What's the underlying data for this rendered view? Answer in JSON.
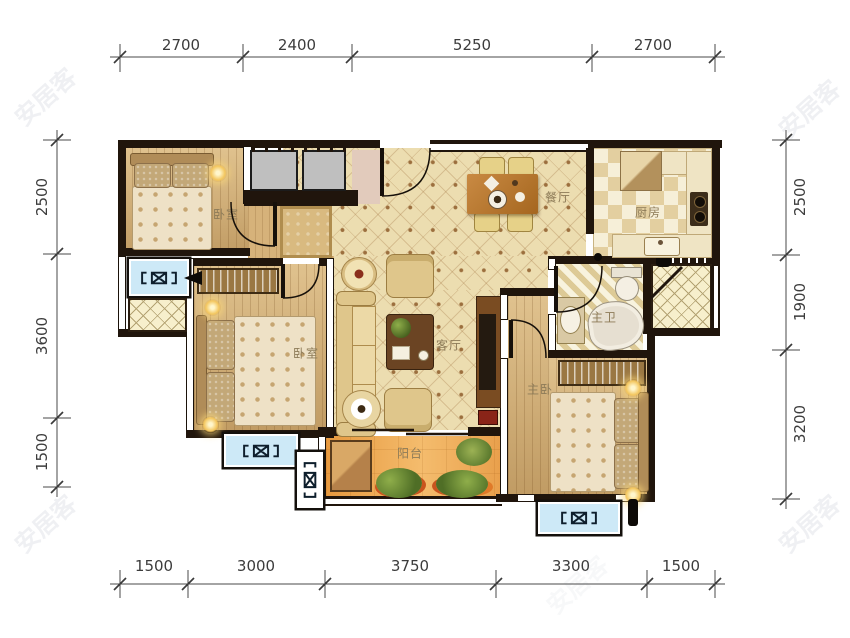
{
  "watermark": {
    "text": "安居客"
  },
  "rooms": {
    "bedroom1": {
      "label": "卧室"
    },
    "bedroom2": {
      "label": "卧室"
    },
    "master_bedroom": {
      "label": "主卧"
    },
    "living_room": {
      "label": "客厅"
    },
    "dining_room": {
      "label": "餐厅"
    },
    "kitchen": {
      "label": "厨房"
    },
    "master_bathroom": {
      "label": "主卫"
    },
    "balcony": {
      "label": "阳台"
    }
  },
  "dimensions_mm": {
    "top": [
      "2700",
      "2400",
      "5250",
      "2700"
    ],
    "bottom": [
      "1500",
      "3000",
      "3750",
      "3300",
      "1500"
    ],
    "left": [
      "2500",
      "3600",
      "1500"
    ],
    "right": [
      "2500",
      "1900",
      "3200"
    ]
  },
  "colors": {
    "wall": "#20150c",
    "wood_floor": "#cfa96f",
    "lattice_floor": "#ecddb0",
    "balcony_floor": "#eda04d",
    "ac_unit": "#cde9f7"
  }
}
